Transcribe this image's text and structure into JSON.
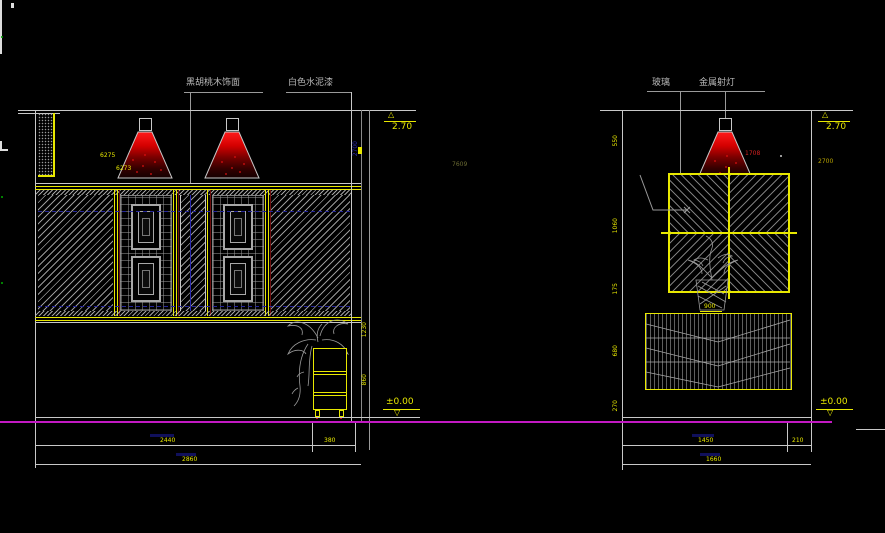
{
  "canvas": {
    "width": 885,
    "height": 533,
    "background": "#000000"
  },
  "colors": {
    "line_white": "#c8c8c8",
    "accent_yellow": "#e8e800",
    "hatch_grey": "#9a9a9a",
    "floor_magenta": "#c319c3",
    "lamp_red": "#e01010",
    "trim_dark_red": "#6e0f0f",
    "aux_blue": "#2a2ab0",
    "dot_green": "#00a000"
  },
  "left": {
    "label_wood": "黑胡桃木饰面",
    "label_paint": "白色水泥漆",
    "level_top": "2.70",
    "level_floor": "±0.00",
    "lamp_tag_a": "6275",
    "lamp_tag_b": "6273",
    "dim_height": "2700",
    "dim_faint": "7609",
    "dim_side_upper": "1230",
    "dim_side_lower": "860",
    "dim_row1_main": "2440",
    "dim_row1_right": "380",
    "dim_row2_total": "2860"
  },
  "right": {
    "label_glass": "玻璃",
    "label_spotlight": "金属射灯",
    "level_top": "2.70",
    "level_floor": "±0.00",
    "lamp_tag": "1708",
    "dim_below_level": "2700",
    "dim_side_a": "550",
    "dim_side_b": "1060",
    "dim_side_c": "175",
    "dim_side_d": "680",
    "dim_side_e": "270",
    "panel_tag": "900",
    "dim_row1_main": "1450",
    "dim_row1_right": "210",
    "dim_row2_total": "1660"
  },
  "marks": {
    "triangle_up": "△",
    "triangle_down": "▽"
  }
}
